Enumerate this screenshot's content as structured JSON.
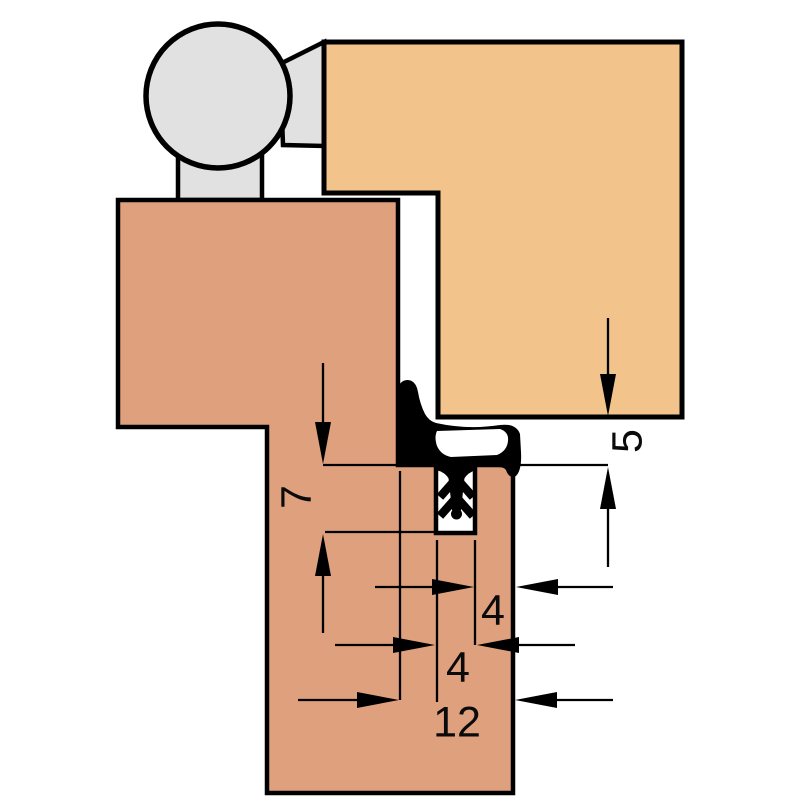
{
  "drawing": {
    "kind": "door-seal-cross-section-technical-drawing",
    "dimension_labels": {
      "groove_depth": "7",
      "seal_gap": "5",
      "edge_to_groove": "4",
      "groove_width": "4",
      "rebate_width": "12"
    },
    "colors": {
      "door_panel": "#f2c48c",
      "frame_profile": "#dfa07e",
      "hinge": "#e1e1e1",
      "seal": "#000000",
      "lines": "#000000",
      "background": "#ffffff"
    }
  }
}
